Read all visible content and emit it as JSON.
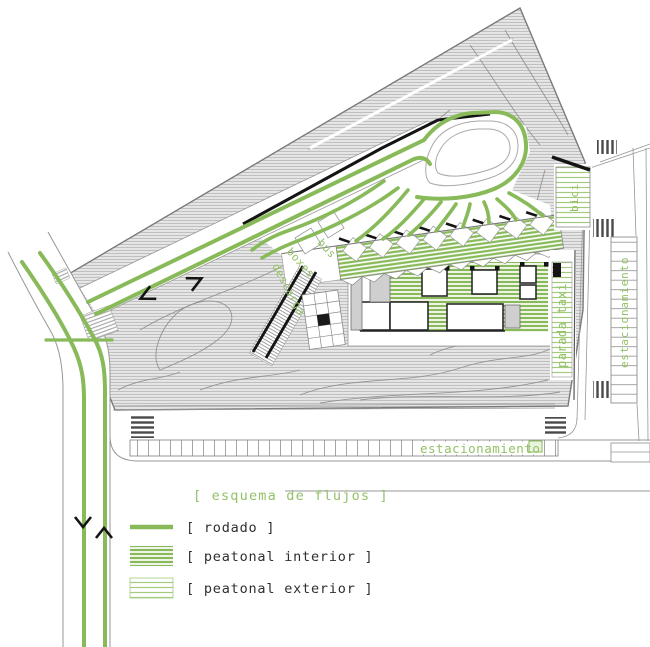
{
  "colors": {
    "green": "#88ba59",
    "green_light": "#a3cb7d",
    "green_text": "#93c167",
    "terrain_fill": "#e6e6e6",
    "terrain_hatch": "#b9b9b9",
    "line_gray": "#979797",
    "line_dark": "#5a5a5a",
    "black": "#141414",
    "label_text": "#2f2f2f"
  },
  "legend": {
    "title": "[ esquema de flujos ]",
    "items": [
      {
        "id": "rodado",
        "label": "[ rodado ]",
        "swatch": "solid-line"
      },
      {
        "id": "peatonal-interior",
        "label": "[ peatonal interior ]",
        "swatch": "stripes-dense"
      },
      {
        "id": "peatonal-exterior",
        "label": "[ peatonal exterior ]",
        "swatch": "stripes-light"
      }
    ]
  },
  "labels": {
    "parking_bottom": "estacionamiento",
    "parking_right": "estacionamiento",
    "bici": "bici",
    "parada_taxi": "parada taxi",
    "bus": "bus",
    "boxes": "boxes",
    "descarga": "descarga"
  }
}
